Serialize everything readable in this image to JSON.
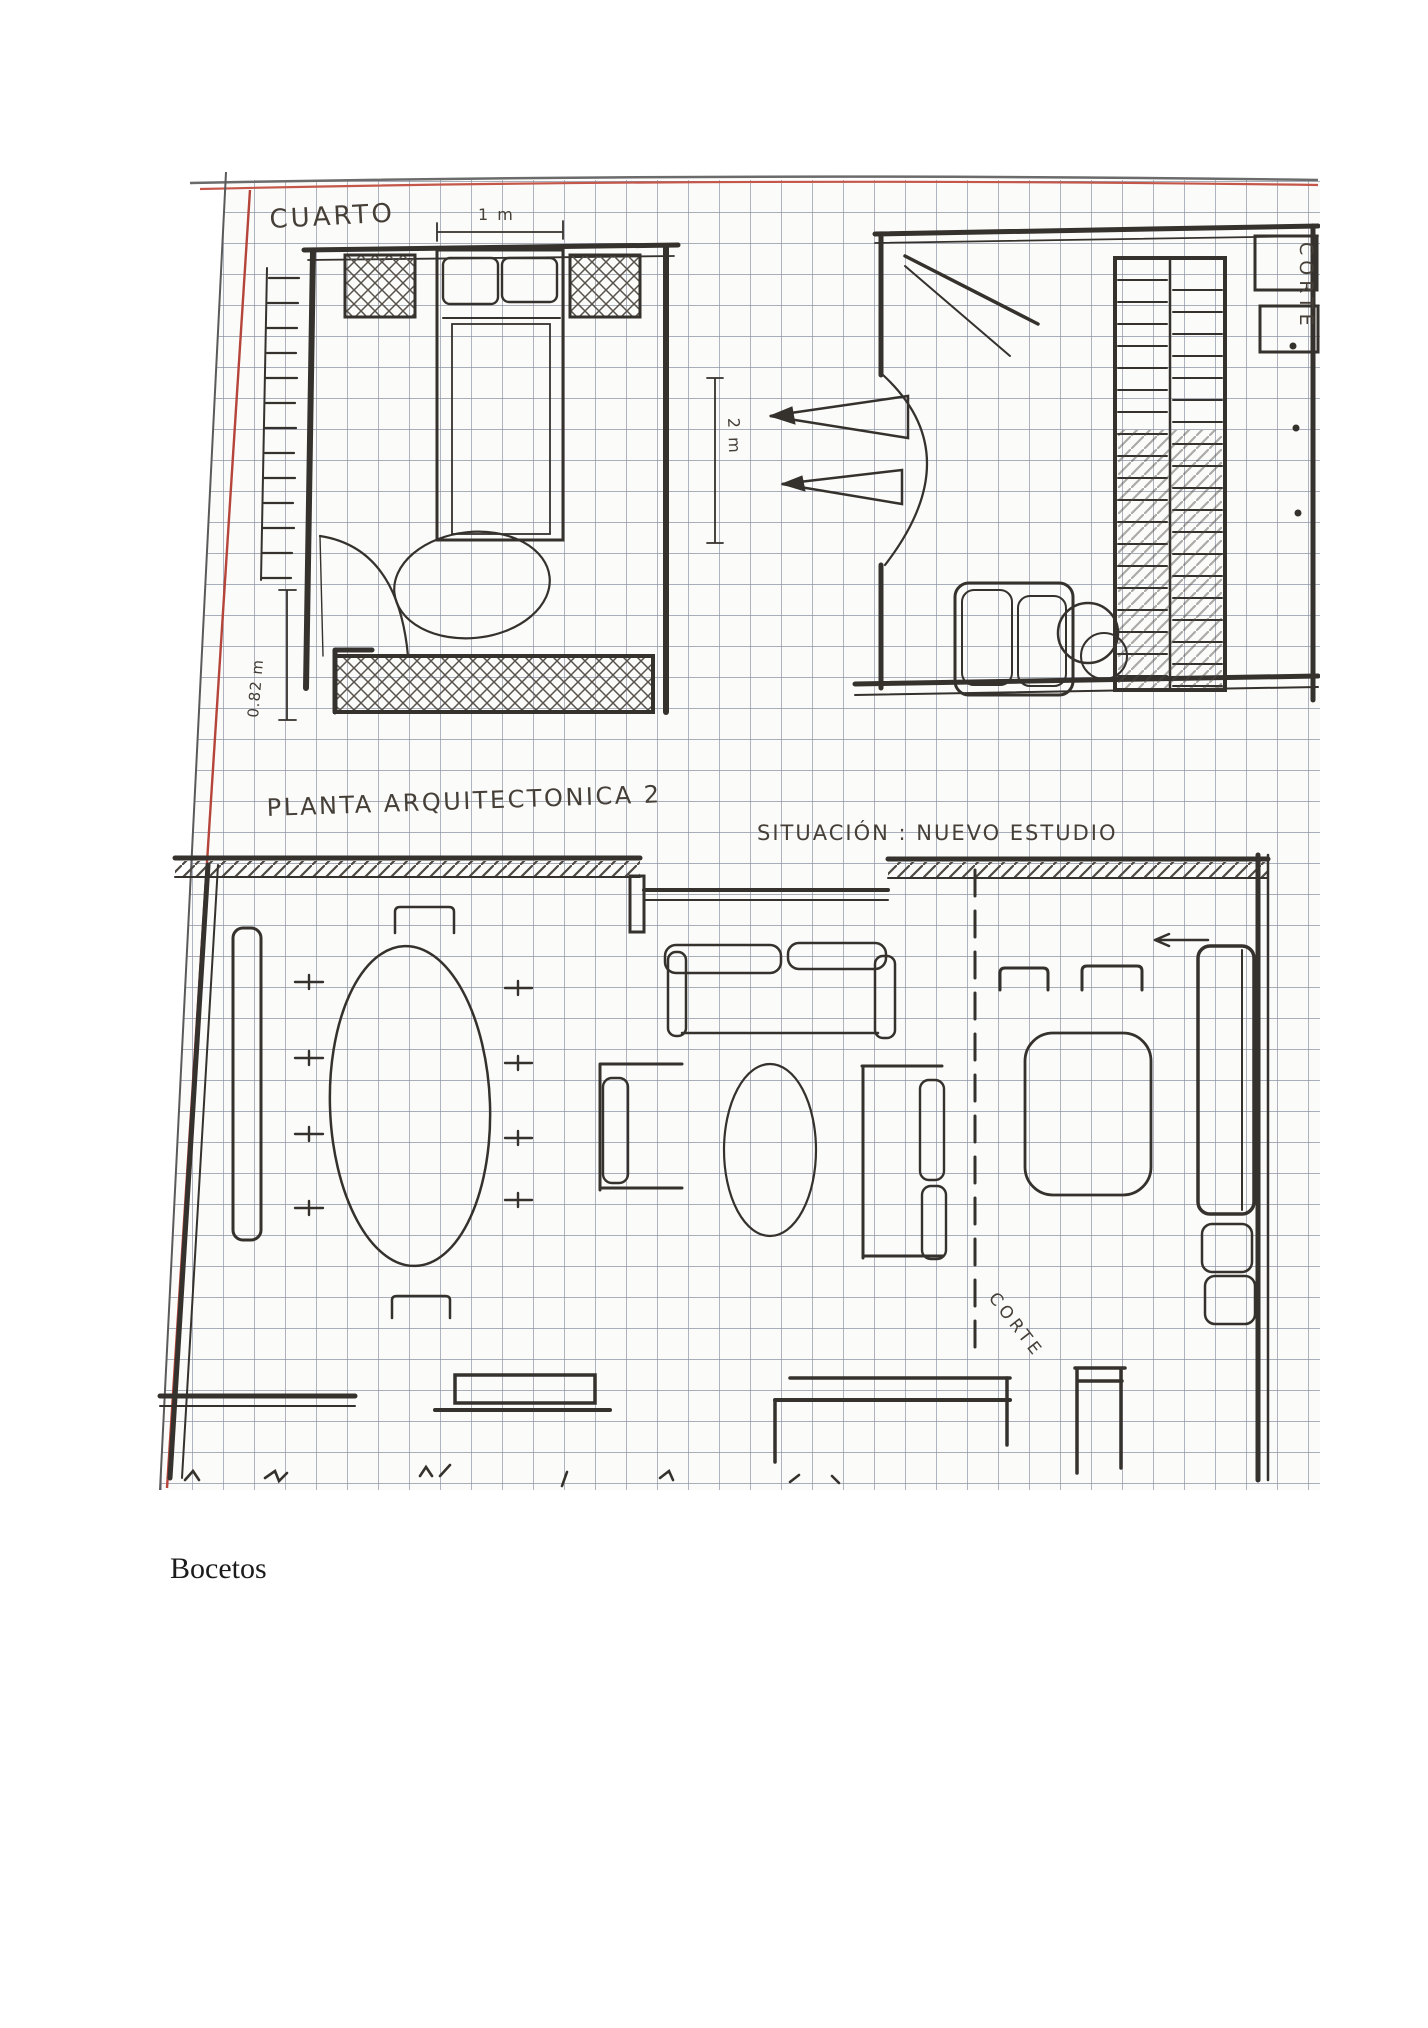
{
  "page": {
    "caption": "Bocetos"
  },
  "sketch": {
    "labels": {
      "room_title": "CUARTO",
      "dim_1m": "1 m",
      "dim_2m": "2 m",
      "dim_082m": "0.82 m",
      "plan_title": "PLANTA ARQUITECTONICA 2",
      "situation_title": "SITUACIÓN : NUEVO ESTUDIO",
      "corte_right": "CORTE",
      "corte_section": "CORTE"
    },
    "colors": {
      "margin_red": "#b5443a",
      "grid_line": "#8d94a6",
      "ink": "#35312d",
      "paper": "#fbfbf9"
    }
  }
}
